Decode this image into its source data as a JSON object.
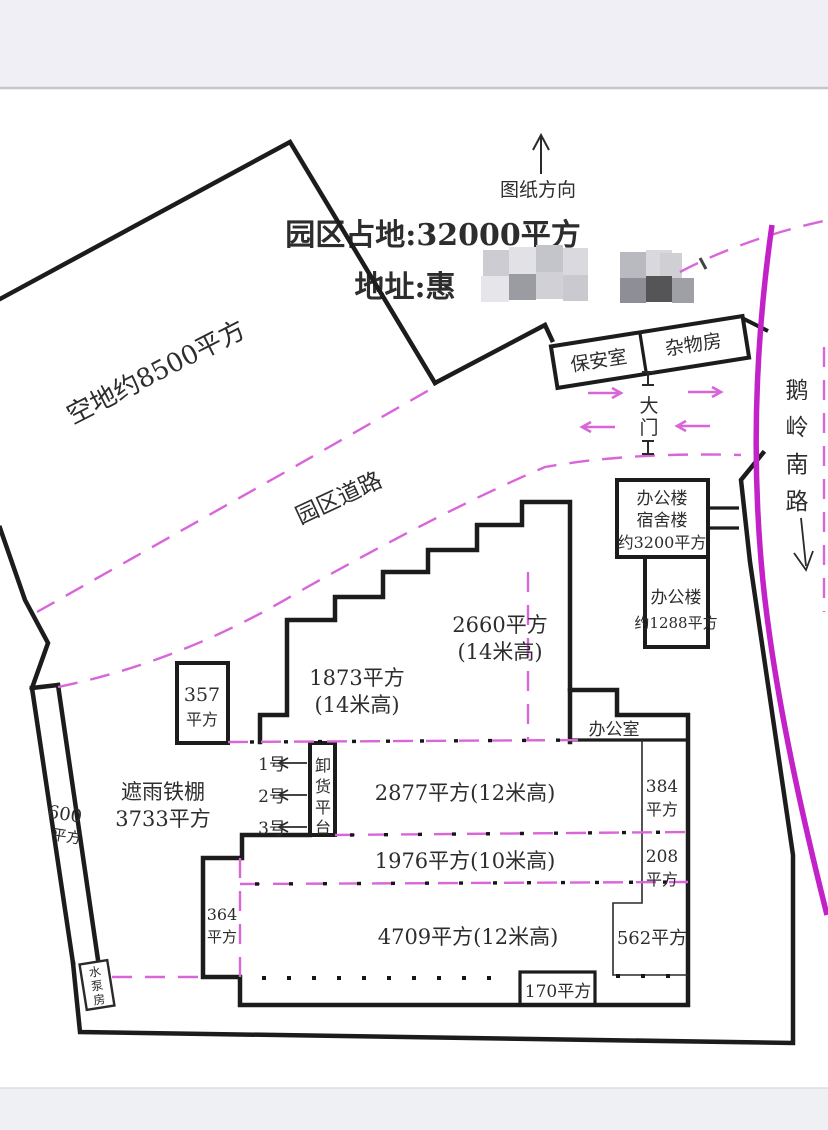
{
  "colors": {
    "line": "#1c1c1c",
    "dash": "#d966d9",
    "road": "#c322c8",
    "text": "#2d2d2d",
    "page": "#eff0f5",
    "photo": "#ffffff"
  },
  "compass": {
    "label": "图纸方向"
  },
  "header": {
    "title": "园区占地:32000平方",
    "address_prefix": "地址:惠"
  },
  "site": {
    "empty_land": "空地约8500平方",
    "park_road": "园区道路",
    "security_room": "保安室",
    "storage_room": "杂物房",
    "gate": "大门",
    "road_name": "鹅岭南路",
    "pump_room": "水泵房"
  },
  "buildings": {
    "office_dorm": {
      "lines": [
        "办公楼",
        "宿舍楼",
        "约3200平方"
      ]
    },
    "office_2": {
      "lines": [
        "办公楼",
        "约1288平方"
      ]
    },
    "office_room": "办公室",
    "hall_1873": {
      "lines": [
        "1873平方",
        "(14米高)"
      ]
    },
    "hall_2660": {
      "lines": [
        "2660平方",
        "(14米高)"
      ]
    },
    "hall_2877": "2877平方(12米高)",
    "hall_1976": "1976平方(10米高)",
    "hall_4709": "4709平方(12米高)",
    "room_384": {
      "lines": [
        "384",
        "平方"
      ]
    },
    "room_208": {
      "lines": [
        "208",
        "平方"
      ]
    },
    "room_562": "562平方",
    "room_170": "170平方",
    "room_364": {
      "lines": [
        "364",
        "平方"
      ]
    },
    "room_357": {
      "lines": [
        "357",
        "平方"
      ]
    },
    "strip_600": {
      "lines": [
        "600",
        "平方"
      ]
    },
    "shed": {
      "lines": [
        "遮雨铁棚",
        "3733平方"
      ]
    }
  },
  "docks": {
    "labels": [
      "1号",
      "2号",
      "3号"
    ],
    "platform": "卸货平台"
  }
}
